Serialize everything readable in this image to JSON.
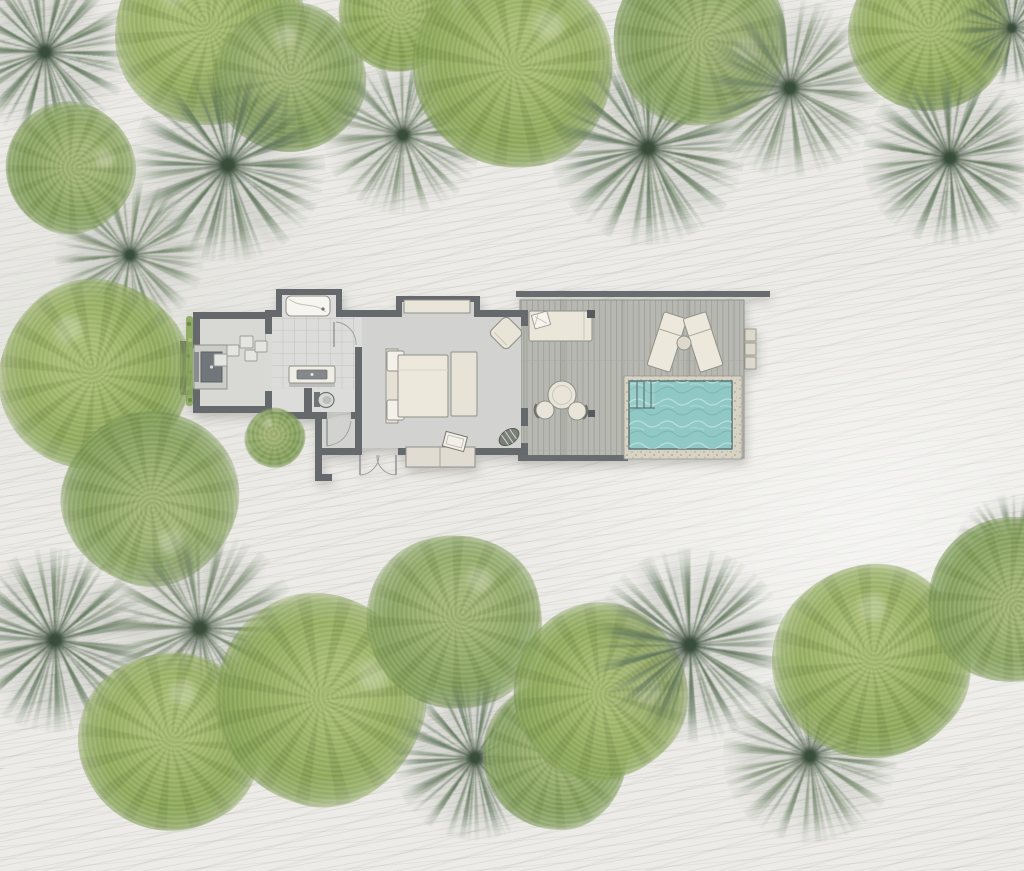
{
  "scene": {
    "description": "top-down site plan of one-bedroom pool villa on sand with palms",
    "width": 1024,
    "height": 768
  },
  "palette": {
    "sand": "#ecebe7",
    "sand_ripple": "#9c9e92",
    "wall": "#65696c",
    "roof_edge": "#686c6f",
    "bedroom_floor": "#d2d3d0",
    "bathroom_floor": "#dcddda",
    "courtyard_floor": "#d8d8d5",
    "deck_plank": "#b7b8b1",
    "deck_plank_line": "#a0a29a",
    "pool_water": "#8fc8c4",
    "pool_caustic": "#def0ee",
    "pool_edge": "#546e70",
    "pool_surround": "#d8d4c5",
    "furniture_cream": "#eae6da",
    "furniture_outline": "#8f9089",
    "hedge_green": "#8ca85f",
    "palm_green": "#60765c",
    "leafy_green": "#8ba462",
    "shower_pad": "#71767b"
  },
  "villa": {
    "rooms": [
      "outdoor-shower-courtyard",
      "bathroom",
      "bedroom",
      "entry-vestibule",
      "pool-deck"
    ],
    "furniture": [
      "outdoor-shower",
      "stepping-stones",
      "hedge",
      "bathtub",
      "vanity-sink",
      "toilet",
      "wardrobe-shelf",
      "double-bed",
      "foot-bench",
      "corner-armchair",
      "woven-pouf",
      "console",
      "tray",
      "daybed",
      "day-pillow",
      "sun-lounger-left",
      "sun-lounger-right",
      "side-table",
      "dining-table",
      "dining-chair-left",
      "dining-chair-right",
      "plunge-pool",
      "pool-steps",
      "deck-side-steps",
      "entry-double-doors"
    ]
  },
  "trees": [
    {
      "type": "palm",
      "x": 45,
      "y": 52,
      "d": 170,
      "rot": 10,
      "v": 1
    },
    {
      "type": "leafy",
      "x": 210,
      "y": 30,
      "d": 190,
      "rot": 0,
      "v": 1
    },
    {
      "type": "leafy",
      "x": 290,
      "y": 78,
      "d": 150,
      "rot": 40,
      "v": 2
    },
    {
      "type": "palm",
      "x": 130,
      "y": 255,
      "d": 150,
      "rot": 80,
      "v": 2
    },
    {
      "type": "palm",
      "x": 228,
      "y": 165,
      "d": 195,
      "rot": 35,
      "v": 1
    },
    {
      "type": "leafy",
      "x": 70,
      "y": 168,
      "d": 130,
      "rot": 120,
      "v": 2
    },
    {
      "type": "leafy",
      "x": 95,
      "y": 375,
      "d": 190,
      "rot": 15,
      "v": 1
    },
    {
      "type": "leafy",
      "x": 150,
      "y": 498,
      "d": 175,
      "rot": 200,
      "v": 2
    },
    {
      "type": "palm",
      "x": 403,
      "y": 135,
      "d": 160,
      "rot": 55,
      "v": 2
    },
    {
      "type": "leafy",
      "x": 397,
      "y": 15,
      "d": 115,
      "rot": 70,
      "v": 1
    },
    {
      "type": "leafy",
      "x": 513,
      "y": 68,
      "d": 200,
      "rot": 85,
      "v": 1
    },
    {
      "type": "palm",
      "x": 648,
      "y": 148,
      "d": 195,
      "rot": 20,
      "v": 1
    },
    {
      "type": "leafy",
      "x": 700,
      "y": 38,
      "d": 175,
      "rot": 150,
      "v": 2
    },
    {
      "type": "palm",
      "x": 790,
      "y": 88,
      "d": 180,
      "rot": 65,
      "v": 2
    },
    {
      "type": "leafy",
      "x": 930,
      "y": 32,
      "d": 160,
      "rot": 30,
      "v": 1
    },
    {
      "type": "palm",
      "x": 1012,
      "y": 28,
      "d": 115,
      "rot": 5,
      "v": 1
    },
    {
      "type": "palm",
      "x": 950,
      "y": 158,
      "d": 175,
      "rot": 95,
      "v": 1
    },
    {
      "type": "leafy",
      "x": 275,
      "y": 438,
      "d": 60,
      "rot": 20,
      "v": 2
    },
    {
      "type": "palm",
      "x": 55,
      "y": 640,
      "d": 185,
      "rot": 45,
      "v": 1
    },
    {
      "type": "palm",
      "x": 200,
      "y": 628,
      "d": 195,
      "rot": 10,
      "v": 2
    },
    {
      "type": "leafy",
      "x": 170,
      "y": 742,
      "d": 180,
      "rot": 60,
      "v": 1
    },
    {
      "type": "leafy",
      "x": 320,
      "y": 700,
      "d": 210,
      "rot": 110,
      "v": 1
    },
    {
      "type": "leafy",
      "x": 455,
      "y": 622,
      "d": 175,
      "rot": 75,
      "v": 2
    },
    {
      "type": "palm",
      "x": 475,
      "y": 758,
      "d": 165,
      "rot": 30,
      "v": 1
    },
    {
      "type": "leafy",
      "x": 555,
      "y": 757,
      "d": 145,
      "rot": 95,
      "v": 2
    },
    {
      "type": "leafy",
      "x": 600,
      "y": 692,
      "d": 175,
      "rot": 135,
      "v": 1
    },
    {
      "type": "palm",
      "x": 690,
      "y": 645,
      "d": 195,
      "rot": 70,
      "v": 1
    },
    {
      "type": "palm",
      "x": 810,
      "y": 756,
      "d": 175,
      "rot": 15,
      "v": 2
    },
    {
      "type": "leafy",
      "x": 872,
      "y": 662,
      "d": 195,
      "rot": 45,
      "v": 1
    },
    {
      "type": "palm",
      "x": 1015,
      "y": 556,
      "d": 125,
      "rot": 85,
      "v": 2
    },
    {
      "type": "leafy",
      "x": 1010,
      "y": 600,
      "d": 165,
      "rot": 170,
      "v": 2
    }
  ]
}
